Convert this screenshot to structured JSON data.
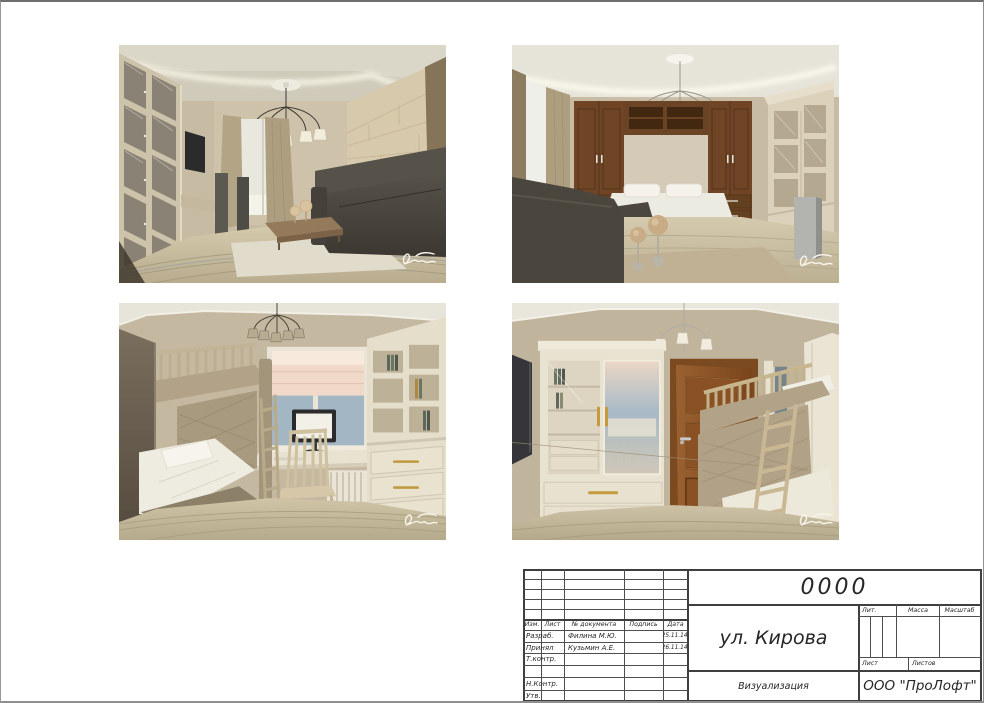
{
  "sheet": {
    "stamp": {
      "code": "0000",
      "title": "ул. Кирова",
      "doc_type": "Визуализация",
      "company": "ООО \"ПроЛофт\"",
      "header": {
        "izm": "Изм.",
        "list": "Лист",
        "doc_num": "№ документа",
        "podpis": "Подпись",
        "data": "Дата"
      },
      "rows": [
        {
          "role": "Разраб.",
          "name": "Филина М.Ю.",
          "date": "25.11.14."
        },
        {
          "role": "Принял",
          "name": "Кузьмин А.Е.",
          "date": "26.11.14."
        },
        {
          "role": "Т.контр.",
          "name": "",
          "date": ""
        },
        {
          "role": "",
          "name": "",
          "date": ""
        },
        {
          "role": "Н.Контр.",
          "name": "",
          "date": ""
        },
        {
          "role": "Утв.",
          "name": "",
          "date": ""
        }
      ],
      "labels": {
        "lit": "Лит.",
        "massa": "Масса",
        "masshtab": "Масштаб",
        "list": "Лист",
        "listov": "Листов"
      }
    },
    "renders": {
      "top_left": "living-room-render",
      "top_right": "bedroom-wall-bed-render",
      "bottom_left": "kids-room-desk-render",
      "bottom_right": "kids-room-door-render",
      "watermark": "artist-signature"
    },
    "colors": {
      "line": "#3f3f3f",
      "paper": "#ffffff"
    }
  }
}
